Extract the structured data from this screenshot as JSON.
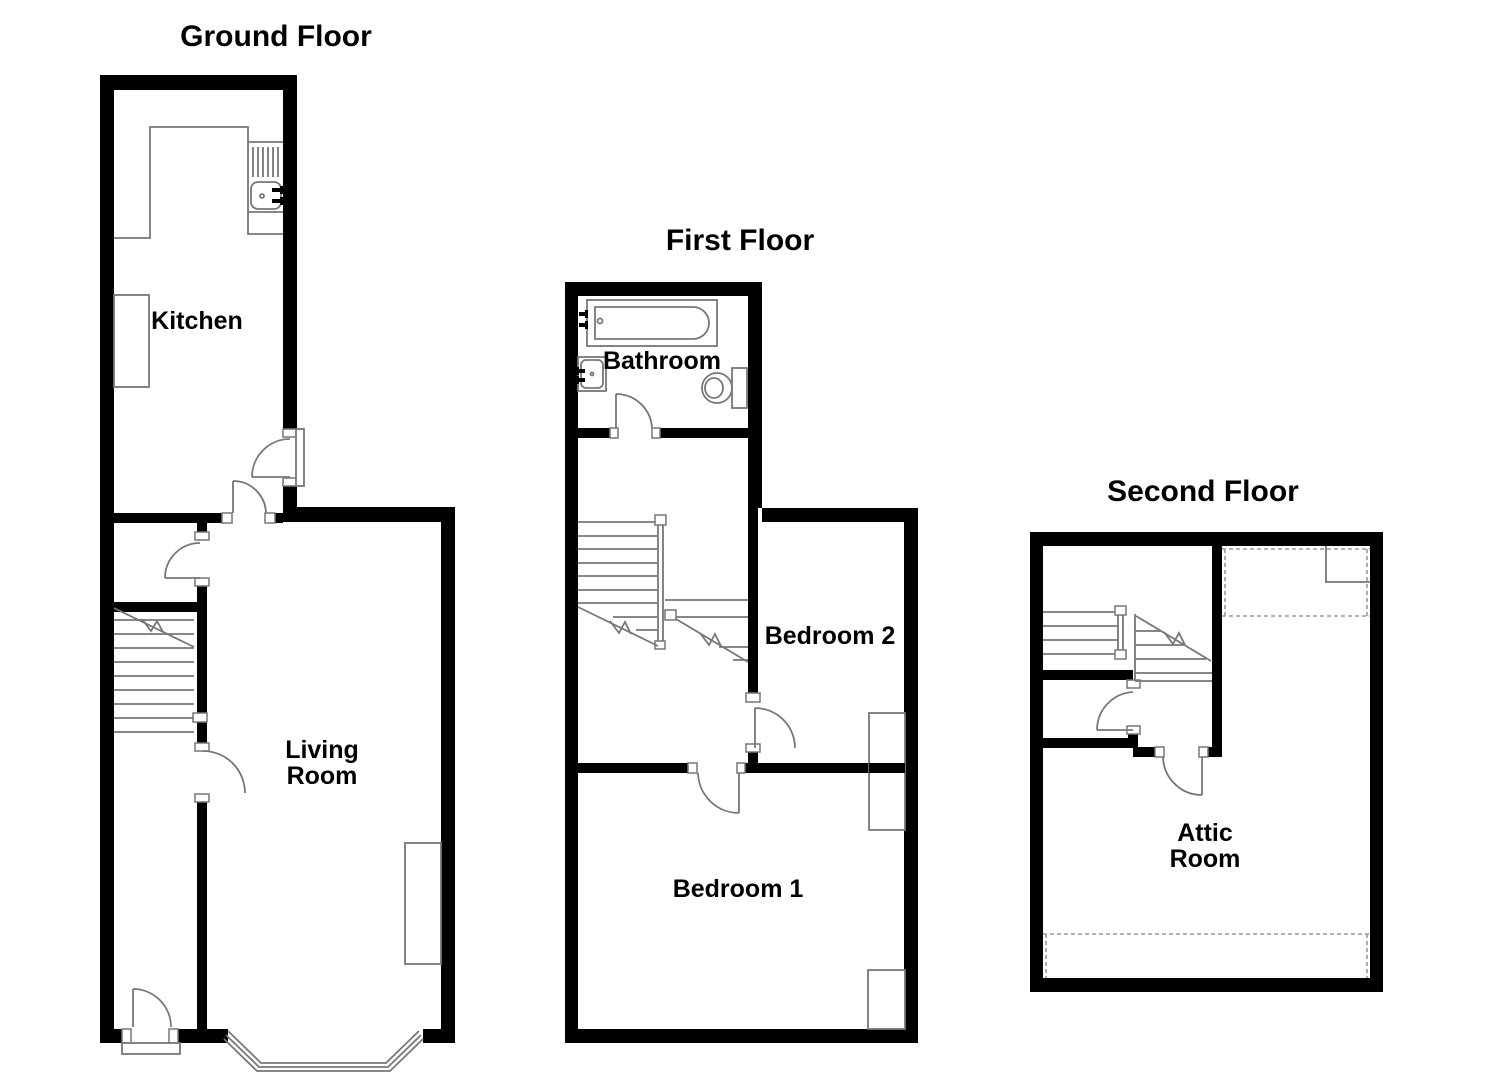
{
  "floors": {
    "ground": {
      "title": "Ground Floor",
      "rooms": {
        "kitchen": "Kitchen",
        "living_line1": "Living",
        "living_line2": "Room"
      }
    },
    "first": {
      "title": "First Floor",
      "rooms": {
        "bathroom": "Bathroom",
        "bedroom2": "Bedroom 2",
        "bedroom1": "Bedroom 1"
      }
    },
    "second": {
      "title": "Second Floor",
      "rooms": {
        "attic_line1": "Attic",
        "attic_line2": "Room"
      }
    }
  },
  "colors": {
    "wall": "#000000",
    "fixture_line": "#777777",
    "dashed_line": "#999999",
    "text": "#000000",
    "background": "#ffffff"
  }
}
